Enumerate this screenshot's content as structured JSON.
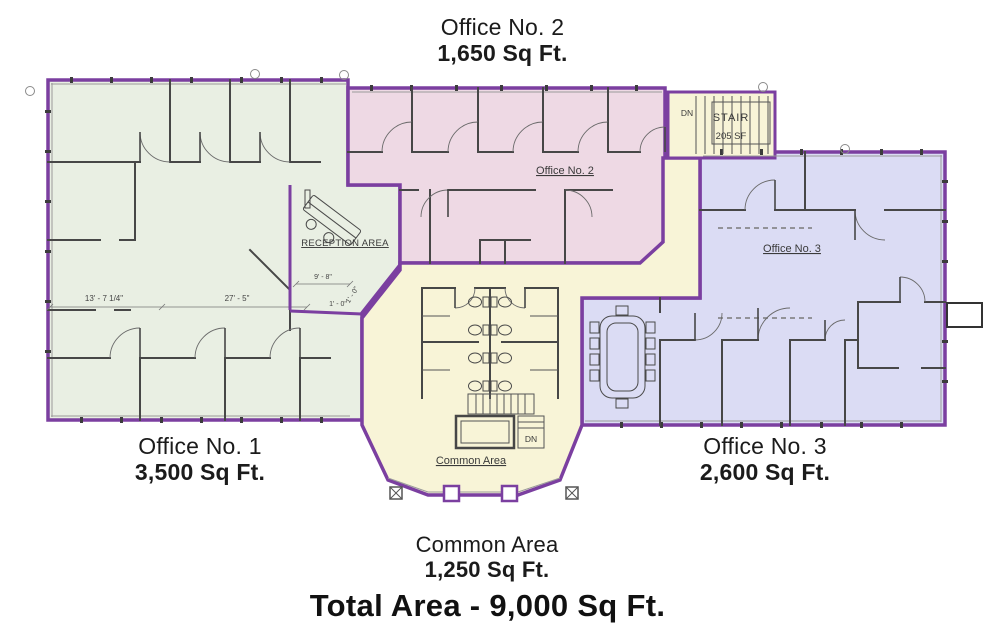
{
  "header": {
    "office2_name": "Office No. 2",
    "office2_area": "1,650 Sq Ft."
  },
  "footer_labels": {
    "office1_name": "Office No. 1",
    "office1_area": "3,500 Sq Ft.",
    "office3_name": "Office No. 3",
    "office3_area": "2,600 Sq Ft.",
    "common_name": "Common Area",
    "common_area": "1,250 Sq Ft.",
    "total": "Total Area - 9,000 Sq Ft."
  },
  "plan": {
    "labels": {
      "reception": "RECEPTION AREA",
      "office2": "Office No. 2",
      "office3": "Office No. 3",
      "common": "Common Area",
      "stair": "STAIR",
      "stair_area": "205 SF",
      "dn_upper": "DN",
      "dn_lower": "DN"
    },
    "dimensions": {
      "left_width": "13' - 7 1/4\"",
      "mid_width": "27' - 5\"",
      "reception_width": "9' - 8\"",
      "offset_h": "1' - 0\"",
      "offset_v": "1' - 0\""
    },
    "regions": [
      {
        "id": "office1",
        "label": "Office No. 1",
        "area": "3,500 Sq Ft.",
        "fill": "#e9efe3"
      },
      {
        "id": "office2",
        "label": "Office No. 2",
        "area": "1,650 Sq Ft.",
        "fill": "#eed9e4"
      },
      {
        "id": "office3",
        "label": "Office No. 3",
        "area": "2,600 Sq Ft.",
        "fill": "#dbdcf4"
      },
      {
        "id": "common",
        "label": "Common Area",
        "area": "1,250 Sq Ft.",
        "fill": "#f8f4d7"
      },
      {
        "id": "stair",
        "label": "STAIR",
        "area": "205 SF",
        "fill": "#f8f4d7"
      }
    ],
    "colors": {
      "wall": "#7b3fa0",
      "interior_wall": "#474747",
      "text": "#3a3a3a"
    },
    "total_area": "9,000 Sq Ft."
  }
}
